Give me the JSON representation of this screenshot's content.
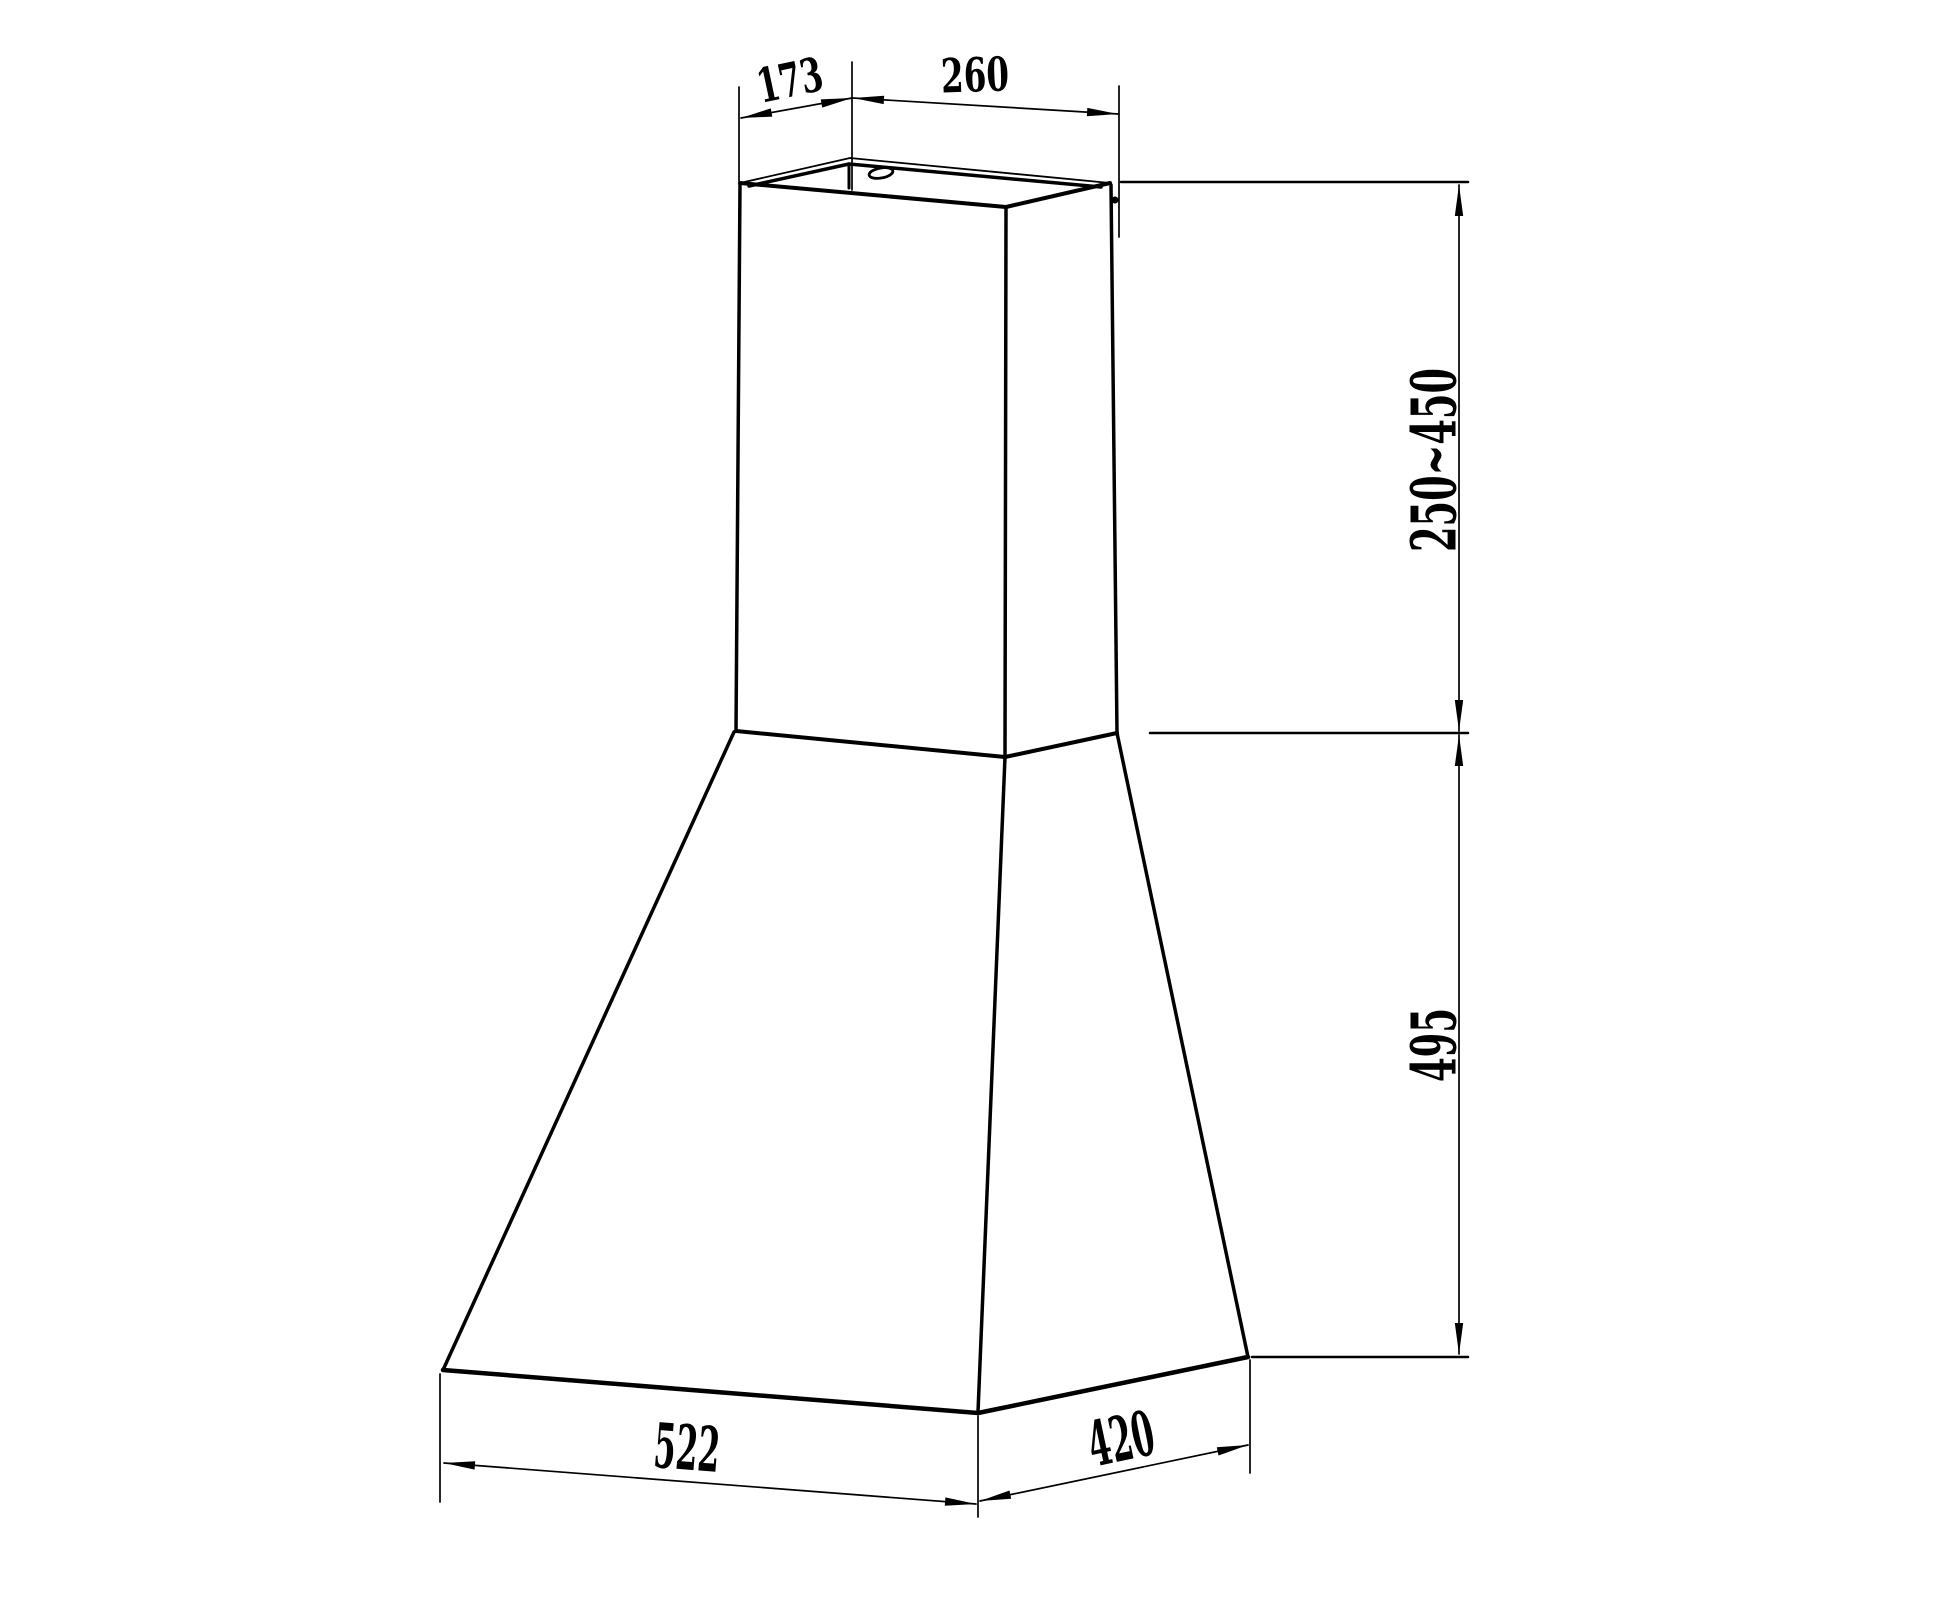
{
  "colors": {
    "line": "#000000",
    "background": "#ffffff"
  },
  "dimensions": {
    "top_depth": "173",
    "top_width": "260",
    "chimney_height_range": "250~450",
    "body_height": "495",
    "base_width": "522",
    "base_depth": "420"
  }
}
